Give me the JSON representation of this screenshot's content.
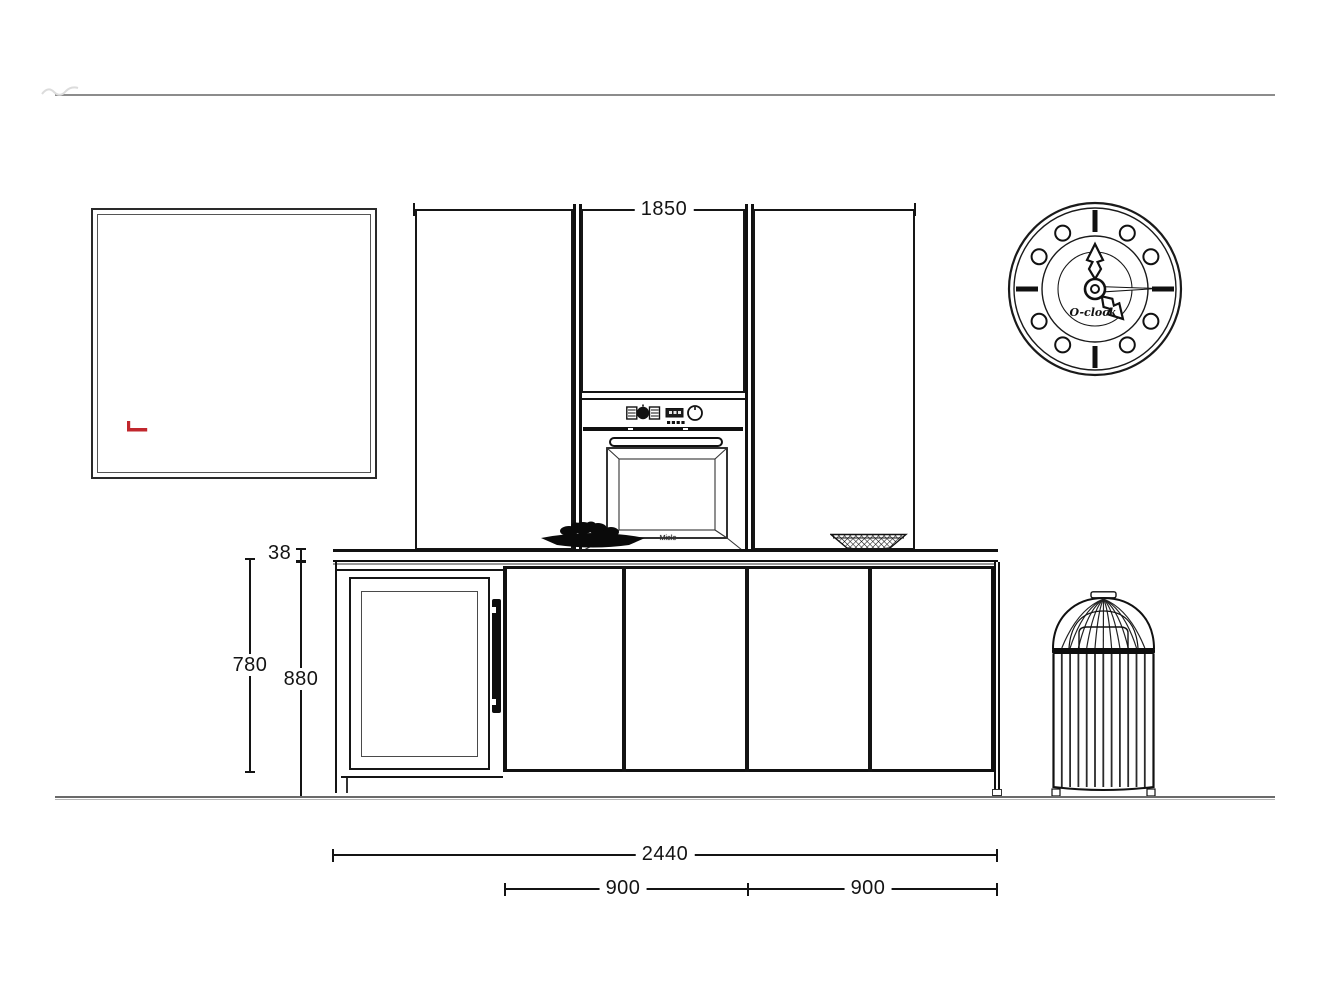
{
  "drawing": {
    "dims": {
      "tall_run_width": "1850",
      "worktop_thickness": "38",
      "base_cabinet_height": "780",
      "worktop_height": "880",
      "total_run_width": "2440",
      "left_module_width": "900",
      "right_module_width": "900"
    },
    "oven": {
      "brand_label": "Miele"
    },
    "clock": {
      "label": "O-clock"
    },
    "colors": {
      "line_black": "#141414",
      "line_gray": "#8c8c8c",
      "accent_red": "#c1272d"
    }
  }
}
